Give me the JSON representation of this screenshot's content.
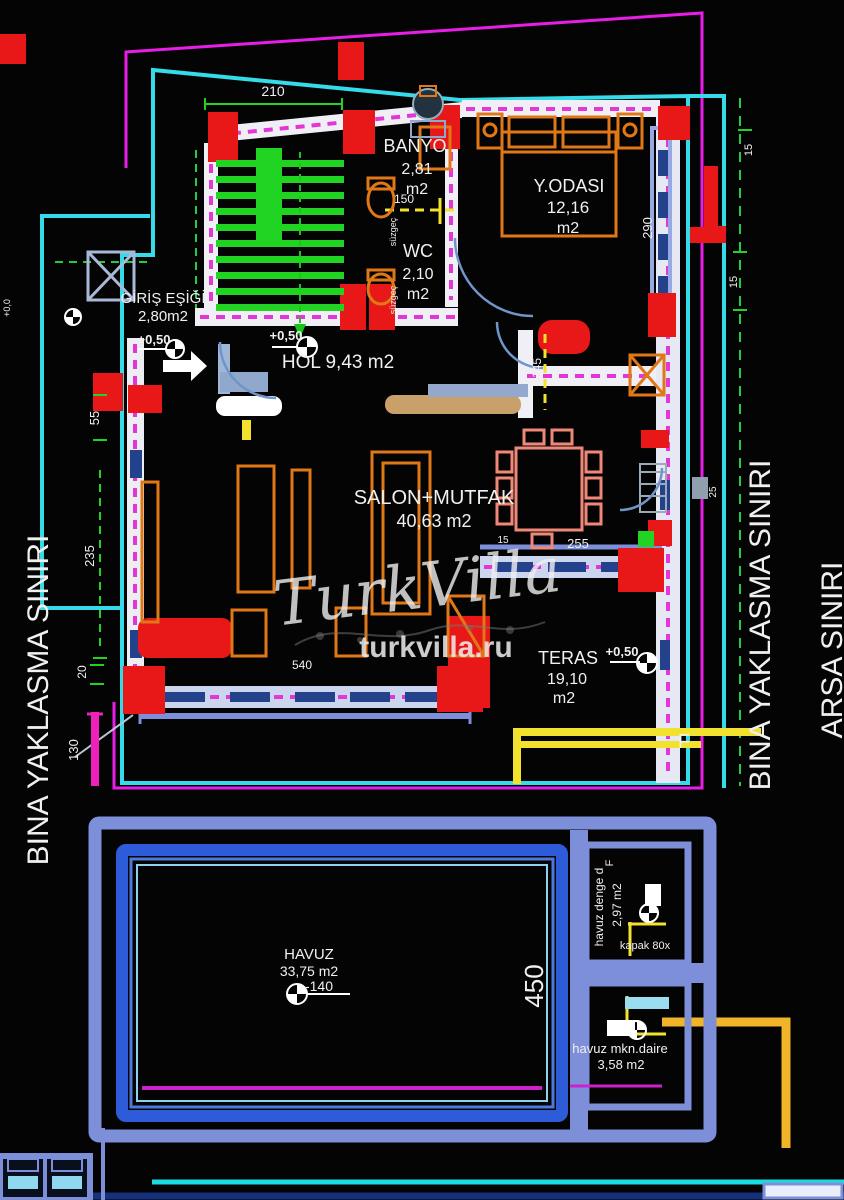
{
  "site": {
    "left_boundary": "BINA YAKLASMA SINIRI",
    "right_boundary": "BINA YAKLASMA SINIRI",
    "parcel": "ARSA SINIRI"
  },
  "rooms": {
    "banyo": {
      "name": "BANYO",
      "area": "2,81",
      "unit": "m2"
    },
    "wc": {
      "name": "WC",
      "area": "2,10",
      "unit": "m2"
    },
    "bedroom": {
      "name": "Y.ODASI",
      "area": "12,16",
      "unit": "m2"
    },
    "entry": {
      "name": "GİRİŞ EŞİĞİ",
      "area": "2,80m2"
    },
    "hall": {
      "name": "HOL 9,43 m2"
    },
    "living": {
      "name": "SALON+MUTFAK",
      "area": "40,63 m2"
    },
    "terrace": {
      "name": "TERAS",
      "area": "19,10",
      "unit": "m2"
    },
    "pool": {
      "name": "HAVUZ",
      "area": "33,75 m2",
      "depth": "-140"
    },
    "balance_tank": {
      "name": "havuz denge d",
      "area": "2,97 m2",
      "hatch": "kapak 80x"
    },
    "machine_room": {
      "name": "havuz mkn.daire",
      "area": "3,58 m2"
    }
  },
  "elevations": {
    "entry_a": "+0,50",
    "entry_b": "+0,50",
    "terrace": "+0,50",
    "datum": "+0,0"
  },
  "dims": {
    "top": "210",
    "left_a": "55",
    "left_b": "235",
    "left_c": "20",
    "left_d": "130",
    "bath": "150",
    "hall_v": "145",
    "bedroom_v": "290",
    "living_w": "255",
    "terrace_w": "540",
    "pool_h": "450",
    "right_a": "15",
    "right_b": "15",
    "right_c": "15",
    "right_note": "25"
  },
  "marks": {
    "section_f": "F",
    "tank_f": "F",
    "drain_a": "süzgeç",
    "drain_b": "süzgeç"
  },
  "watermark": {
    "brand": "TurkVilla",
    "site": "turkvilla.ru"
  },
  "colors": {
    "background": "#000000",
    "boundary_magenta": "#e81ee8",
    "boundary_cyan": "#35dbe8",
    "wall_fill": "#efeff5",
    "wall_axis_magenta": "#e236d6",
    "column_red": "#e81818",
    "stair_green": "#22d422",
    "dim_yellow": "#f2e22e",
    "furniture_orange": "#e07818",
    "dining_coral": "#f08878",
    "pool_blue": "#2e5cd8",
    "pool_frame_periwinkle": "#7d8fd8",
    "pipe_amber": "#f0b429",
    "site_text_left": "#35dbe8",
    "site_text_right": "#a8cdee"
  }
}
